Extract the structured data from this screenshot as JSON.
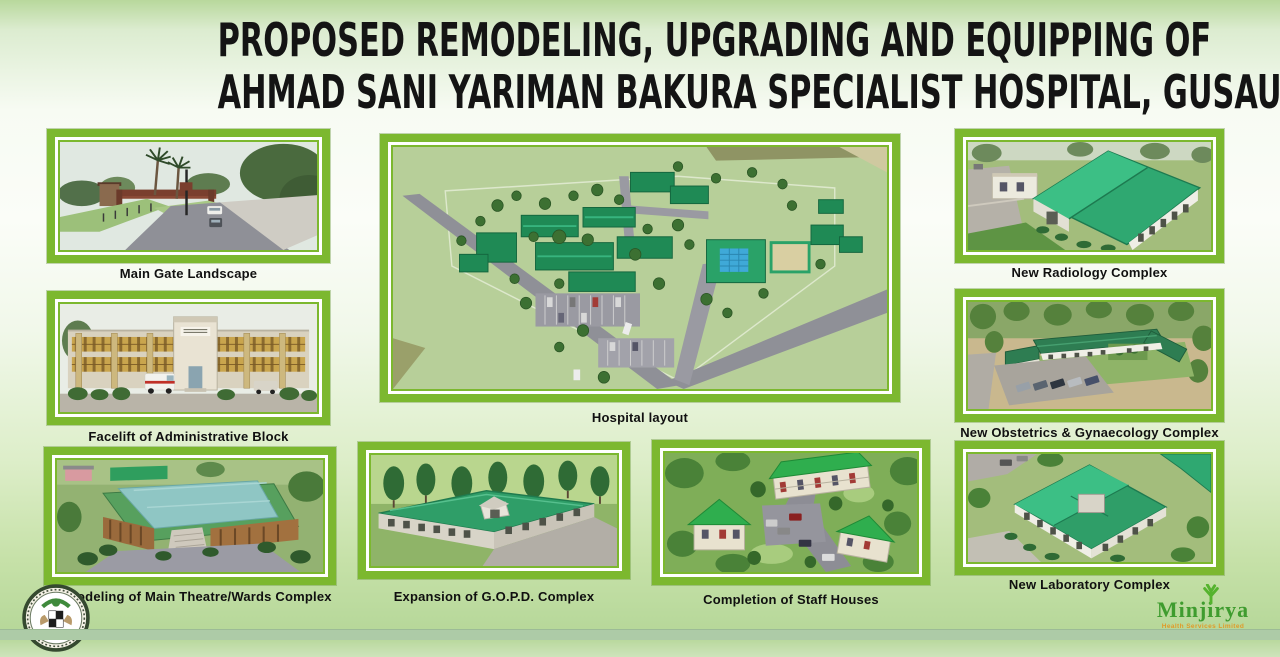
{
  "title": {
    "line1": "PROPOSED REMODELING, UPGRADING AND EQUIPPING OF",
    "line2": "AHMAD SANI YARIMAN BAKURA SPECIALIST HOSPITAL, GUSAU."
  },
  "panels": {
    "main_gate": {
      "caption": "Main Gate Landscape"
    },
    "admin_block": {
      "caption": "Facelift of Administrative Block"
    },
    "theatre_wards": {
      "caption": "Remodeling of Main Theatre/Wards Complex"
    },
    "hospital_layout": {
      "caption": "Hospital layout"
    },
    "gopd": {
      "caption": "Expansion of G.O.P.D.  Complex"
    },
    "staff_houses": {
      "caption": "Completion of Staff Houses"
    },
    "radiology": {
      "caption": "New Radiology Complex"
    },
    "obstetrics": {
      "caption": "New Obstetrics & Gynaecology Complex"
    },
    "laboratory": {
      "caption": "New Laboratory Complex"
    }
  },
  "logos": {
    "minjirya": {
      "name": "Minjirya",
      "tagline": "Health Services Limited"
    }
  },
  "colors": {
    "frame_green": "#7cb82f",
    "title_black": "#141414",
    "roof_green": "#2f9e68",
    "logo_green": "#3f9c2f",
    "tagline_orange": "#e09a28"
  }
}
